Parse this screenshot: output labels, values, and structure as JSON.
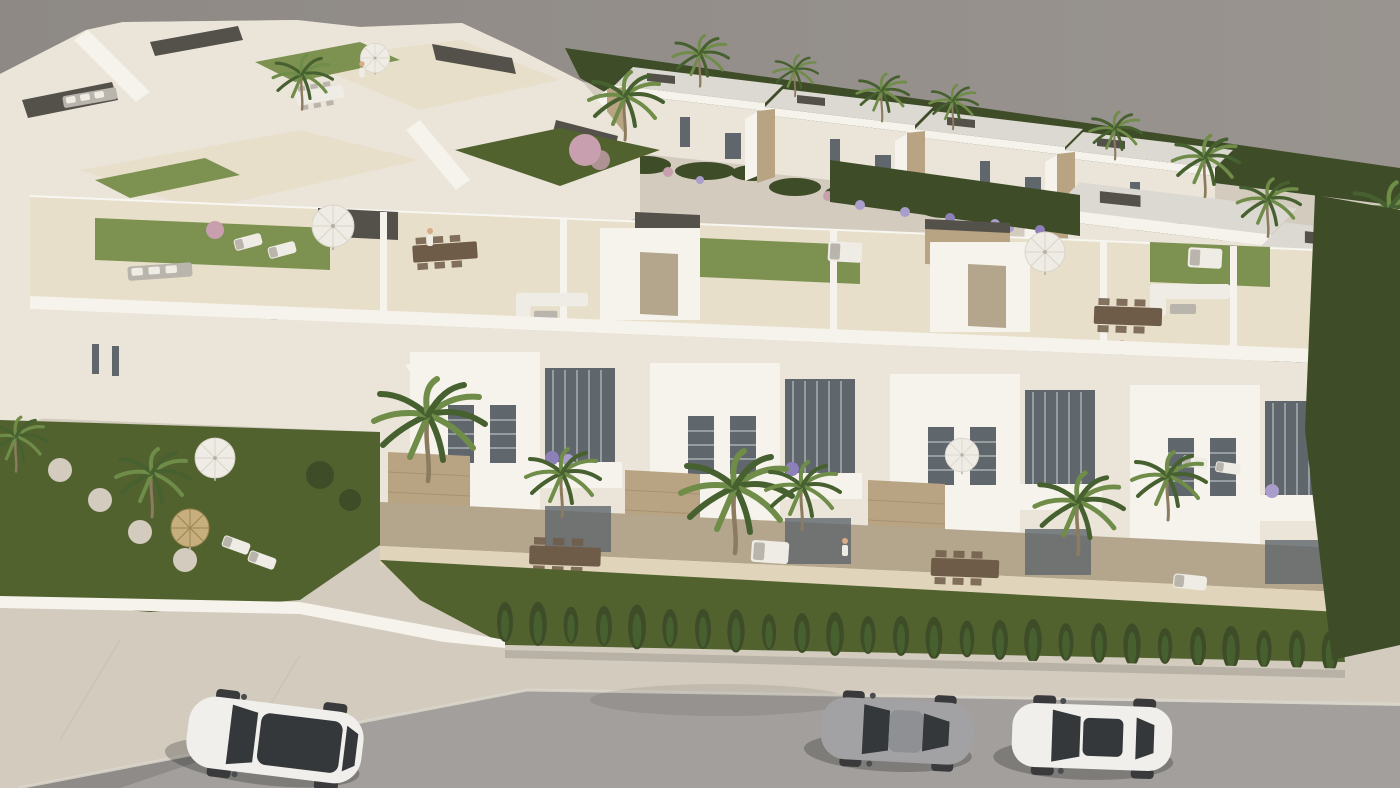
{
  "meta": {
    "title": "Aerial 3D architectural render of a modern white residential development",
    "image_type": "architectural-visualization",
    "view": "high-angle aerial, diagonal composition",
    "time_of_day": "daylight, sun from upper right"
  },
  "palette": {
    "sky": "#8e8985",
    "sky_light": "#99948f",
    "wall_bright": "#f6f3ec",
    "wall": "#eae4d9",
    "wall_shadow": "#d7cfc1",
    "wall_deep": "#bcb2a0",
    "roof_slab": "#dcd9d3",
    "floor": "#e8dfca",
    "floor_warm": "#e0d5ba",
    "under_shadow": "#b3a68d",
    "stone": "#b8a383",
    "stone_dark": "#97825f",
    "pergola": "#54504a",
    "glass": "#5f666c",
    "glass_light": "#8d949a",
    "turf": "#7d9251",
    "lawn": "#51622f",
    "hedge": "#3e4d28",
    "palm_light": "#6f8c49",
    "palm_dark": "#47602f",
    "trunk": "#8c7b5e",
    "flower_purple": "#8d80b8",
    "flower_lilac": "#a99ecb",
    "flower_pink": "#c79fae",
    "sidewalk": "#d2cbbe",
    "road": "#a29f9c",
    "curb": "#dcd7cd",
    "car_white": "#f1efec",
    "car_gray": "#a2a2a5",
    "car_glass": "#34383b",
    "furniture_white": "#efece5",
    "furniture_gray": "#b9b5ac",
    "wood": "#6e5c49"
  },
  "scene": {
    "background": "flat gray sky filling the upper right",
    "buildings": {
      "far_townhouse_cluster": "upper left, white flat-roofed units with roof terraces, dark pergolas and stairs",
      "background_villa_row": {
        "count": 6,
        "features": [
          "flat light roofs",
          "stone clad pillars",
          "gardens with shrubs",
          "hedge behind"
        ]
      },
      "main_townhouse_block": {
        "units": 4,
        "levels": [
          "rooftop solarium",
          "balcony level",
          "ground terraces"
        ],
        "features": [
          "artificial turf patches",
          "dark pergolas",
          "white parasols",
          "outdoor sofas and dining sets",
          "stone-clad accent panels",
          "louvered windows",
          "flower boxes"
        ]
      }
    },
    "vegetation": {
      "palm_trees": 18,
      "cypress_hedge_row": 26,
      "front_lawn": true,
      "rooftop_lawns": 3,
      "flower_colors": [
        "purple",
        "lilac",
        "pink"
      ]
    },
    "street": {
      "sidewalk": "light concrete band with wide driveway wedge at left",
      "road": "gray asphalt across the bottom",
      "vehicles": [
        {
          "id": "car-white-suv",
          "type": "SUV with dark panoramic roof",
          "color": "white",
          "position": "bottom left"
        },
        {
          "id": "car-gray-coupe",
          "type": "sports coupe",
          "color": "gray",
          "position": "bottom center-right"
        },
        {
          "id": "car-white-sedan",
          "type": "sedan with dark sunroof",
          "color": "white",
          "position": "bottom right"
        }
      ]
    },
    "people": [
      {
        "where": "left rooftop terrace",
        "pose": "walking"
      },
      {
        "where": "right rooftop terrace",
        "pose": "standing pair at railing"
      },
      {
        "where": "ground terrace",
        "pose": "walking"
      },
      {
        "where": "far cluster terrace",
        "pose": "standing"
      }
    ],
    "parasols": {
      "white": 5,
      "straw": 1
    }
  }
}
